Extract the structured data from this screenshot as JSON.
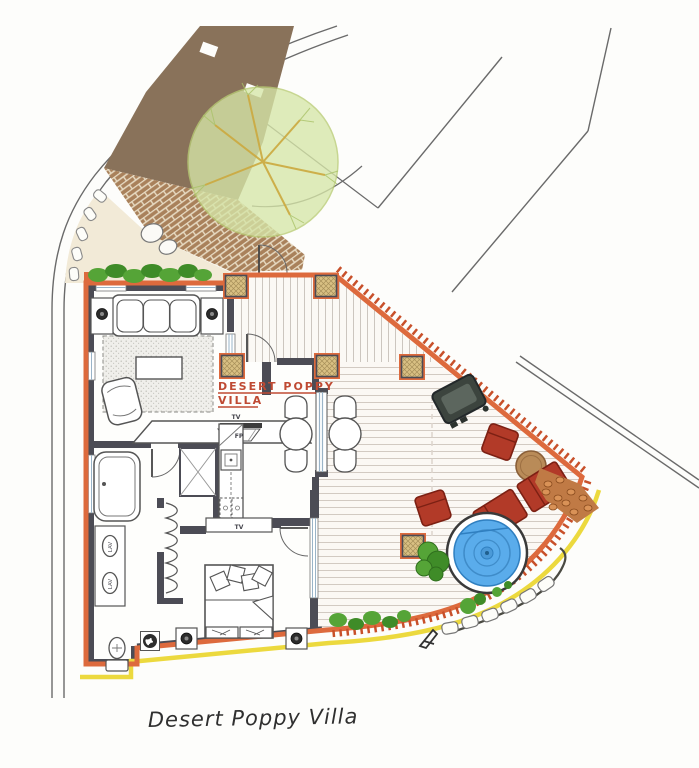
{
  "canvas": {
    "width": 699,
    "height": 768
  },
  "labels": {
    "villa_tag_line1": "DESERT POPPY",
    "villa_tag_line2": "VILLA",
    "caption": "Desert Poppy Villa",
    "living_tv": "TV",
    "living_fireplace": "FP",
    "bedroom_tv": "TV",
    "lav_1": "LAV",
    "lav_2": "LAV"
  },
  "colors": {
    "exterior_wall": "#dd6a3d",
    "trim_zigzag": "#c8502a",
    "curb_yellow": "#ecd93e",
    "interior_wall": "#4c4c55",
    "villa_tag_text": "#bf4a33",
    "driveway_brown": "#89725a",
    "brick_path": "#a9815b",
    "tree_canopy": "#d6e6a8",
    "hedge_green": "#55a437",
    "gravel": "#f2ead7",
    "pool_water": "#5aaceb",
    "furniture_red": "#b23a28",
    "wood_table": "#b98b58",
    "grill_body": "#3c443e",
    "post_tan": "#d9c083",
    "road_line": "#6a6a6a",
    "window_glass": "#9ab4c8"
  }
}
